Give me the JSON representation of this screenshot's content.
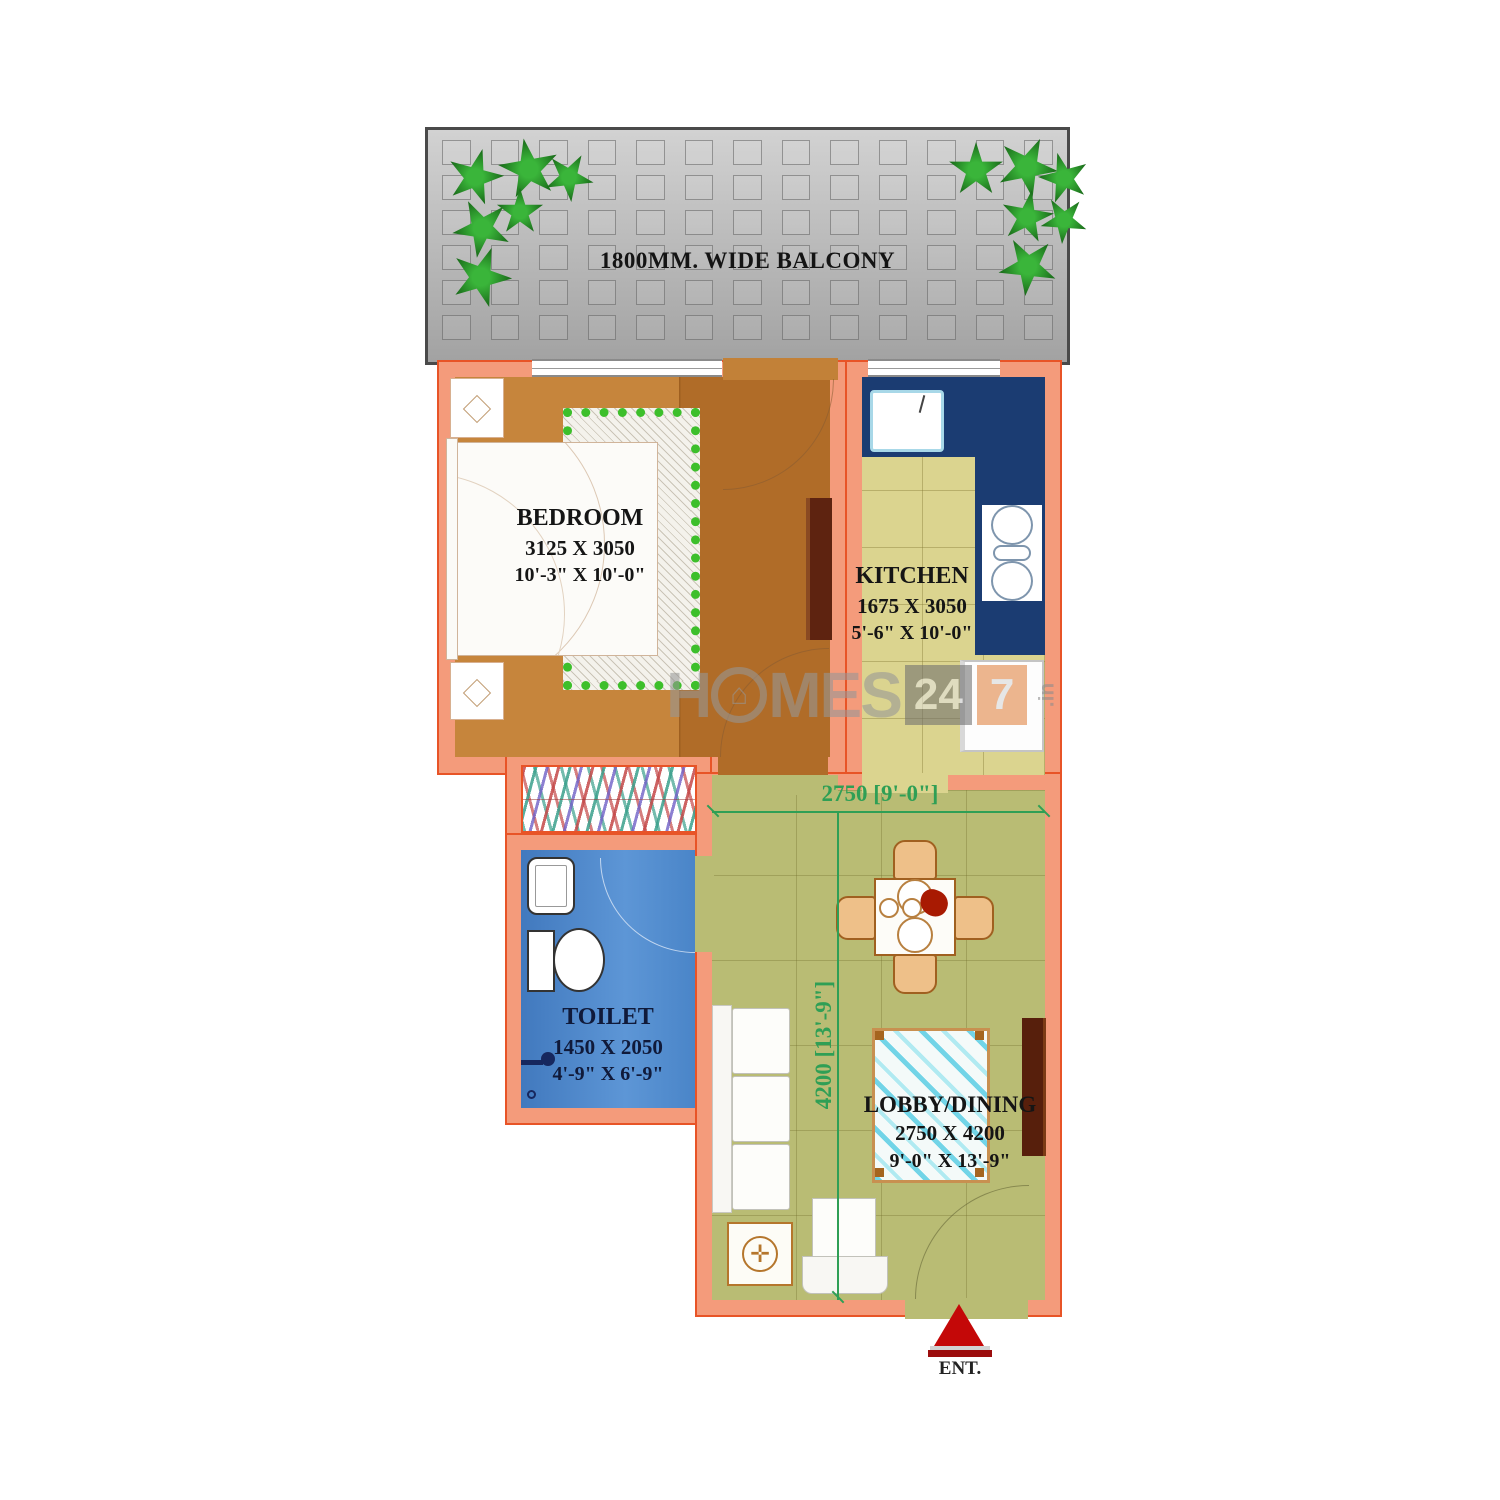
{
  "balcony": {
    "label": "1800MM. WIDE BALCONY"
  },
  "rooms": {
    "bedroom": {
      "name": "BEDROOM",
      "size_mm": "3125 X 3050",
      "size_ft": "10'-3\" X 10'-0\""
    },
    "kitchen": {
      "name": "KITCHEN",
      "size_mm": "1675 X 3050",
      "size_ft": "5'-6\" X 10'-0\""
    },
    "toilet": {
      "name": "TOILET",
      "size_mm": "1450 X 2050",
      "size_ft": "4'-9\" X 6'-9\""
    },
    "lobby_dining": {
      "name": "LOBBY/DINING",
      "size_mm": "2750 X 4200",
      "size_ft": "9'-0\" X 13'-9\""
    }
  },
  "dimensions": {
    "lobby_width": "2750 [9'-0\"]",
    "lobby_height": "4200 [13'-9\"]"
  },
  "entrance_label": "ENT.",
  "watermark": {
    "prefix": "H",
    "house_icon": "⌂",
    "mid": "MES",
    "box_24": "24",
    "box_7": "7",
    "suffix": ".in"
  },
  "colors": {
    "wall": "#f49b7b",
    "wall_outline": "#e85427",
    "bedroom_floor": "#bd7b35",
    "kitchen_floor": "#dbd48f",
    "lobby_floor": "#b9bc74",
    "toilet_floor": "#4b87cb",
    "kitchen_counter": "#1b3c72",
    "balcony": "#b5b5b5",
    "dimension_text": "#2f9f55",
    "plant": "#1e7d1e",
    "entry_arrow": "#c40808",
    "dark_wood": "#571f0c"
  }
}
